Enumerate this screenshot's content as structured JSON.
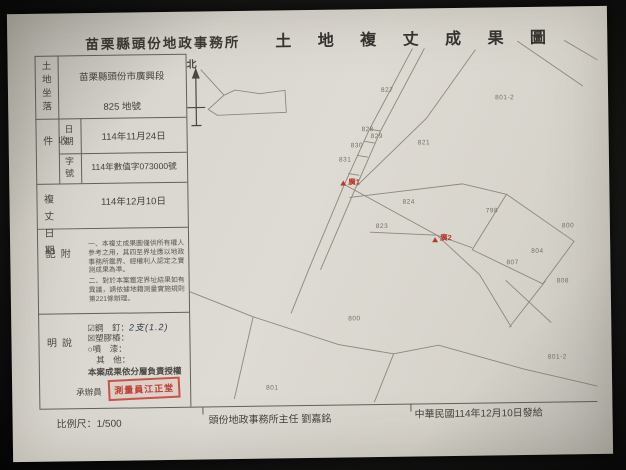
{
  "header": {
    "office": "苗栗縣頭份地政事務所",
    "title": "土 地 複 丈 成 果 圖"
  },
  "info": {
    "land_location": {
      "label": "土地坐落",
      "line1": "苗栗縣頭份市廣興段",
      "line2": "825 地號"
    },
    "receipt": {
      "label": "收件",
      "date_label": "日期",
      "date_value": "114年11月24日",
      "number_label": "字號",
      "number_value": "114年數值字073000號"
    },
    "survey_date": {
      "label": "複丈日期",
      "value": "114年12月10日"
    },
    "notes": {
      "label": "附記",
      "text1": "一、本複丈成果圖僅供所有權人參考之用，其四至界址應以地政事務所鑑界、經權利人認定之實測成果為準。",
      "text2": "二、對於本案鑑定界址結果如有異議，請依據地籍測量實施規則第221條辦理。"
    },
    "explanation": {
      "label": "說明",
      "items": [
        {
          "mark": "☑",
          "name": "鋼　釘：",
          "value": "2支(1.2)"
        },
        {
          "mark": "☒",
          "name": "塑膠樁：",
          "value": ""
        },
        {
          "mark": "○",
          "name": "噴　漆：",
          "value": ""
        },
        {
          "mark": "　",
          "name": "其　他：",
          "value": ""
        }
      ],
      "authorization": "本案成果依分層負責授權",
      "handler_label": "承辦員",
      "stamp_text": "測量員江正堂"
    }
  },
  "footer": {
    "scale": "比例尺：1/500",
    "chief": "頭份地政事務所主任 劉嘉銘",
    "issue_date": "中華民國114年12月10日發給"
  },
  "map": {
    "north_label": "北",
    "labels": [
      {
        "text": "827"
      },
      {
        "text": "801-2"
      },
      {
        "text": "828"
      },
      {
        "text": "829"
      },
      {
        "text": "830"
      },
      {
        "text": "831"
      },
      {
        "text": "821"
      },
      {
        "text": "824"
      },
      {
        "text": "823"
      },
      {
        "text": "798"
      },
      {
        "text": "800"
      },
      {
        "text": "804"
      },
      {
        "text": "807"
      },
      {
        "text": "808"
      },
      {
        "text": "800"
      },
      {
        "text": "801"
      },
      {
        "text": "801-2"
      }
    ],
    "red_points": [
      {
        "text": "廣1"
      },
      {
        "text": "廣2"
      }
    ],
    "colors": {
      "line": "#8d887b",
      "red": "#b53a2c"
    }
  }
}
